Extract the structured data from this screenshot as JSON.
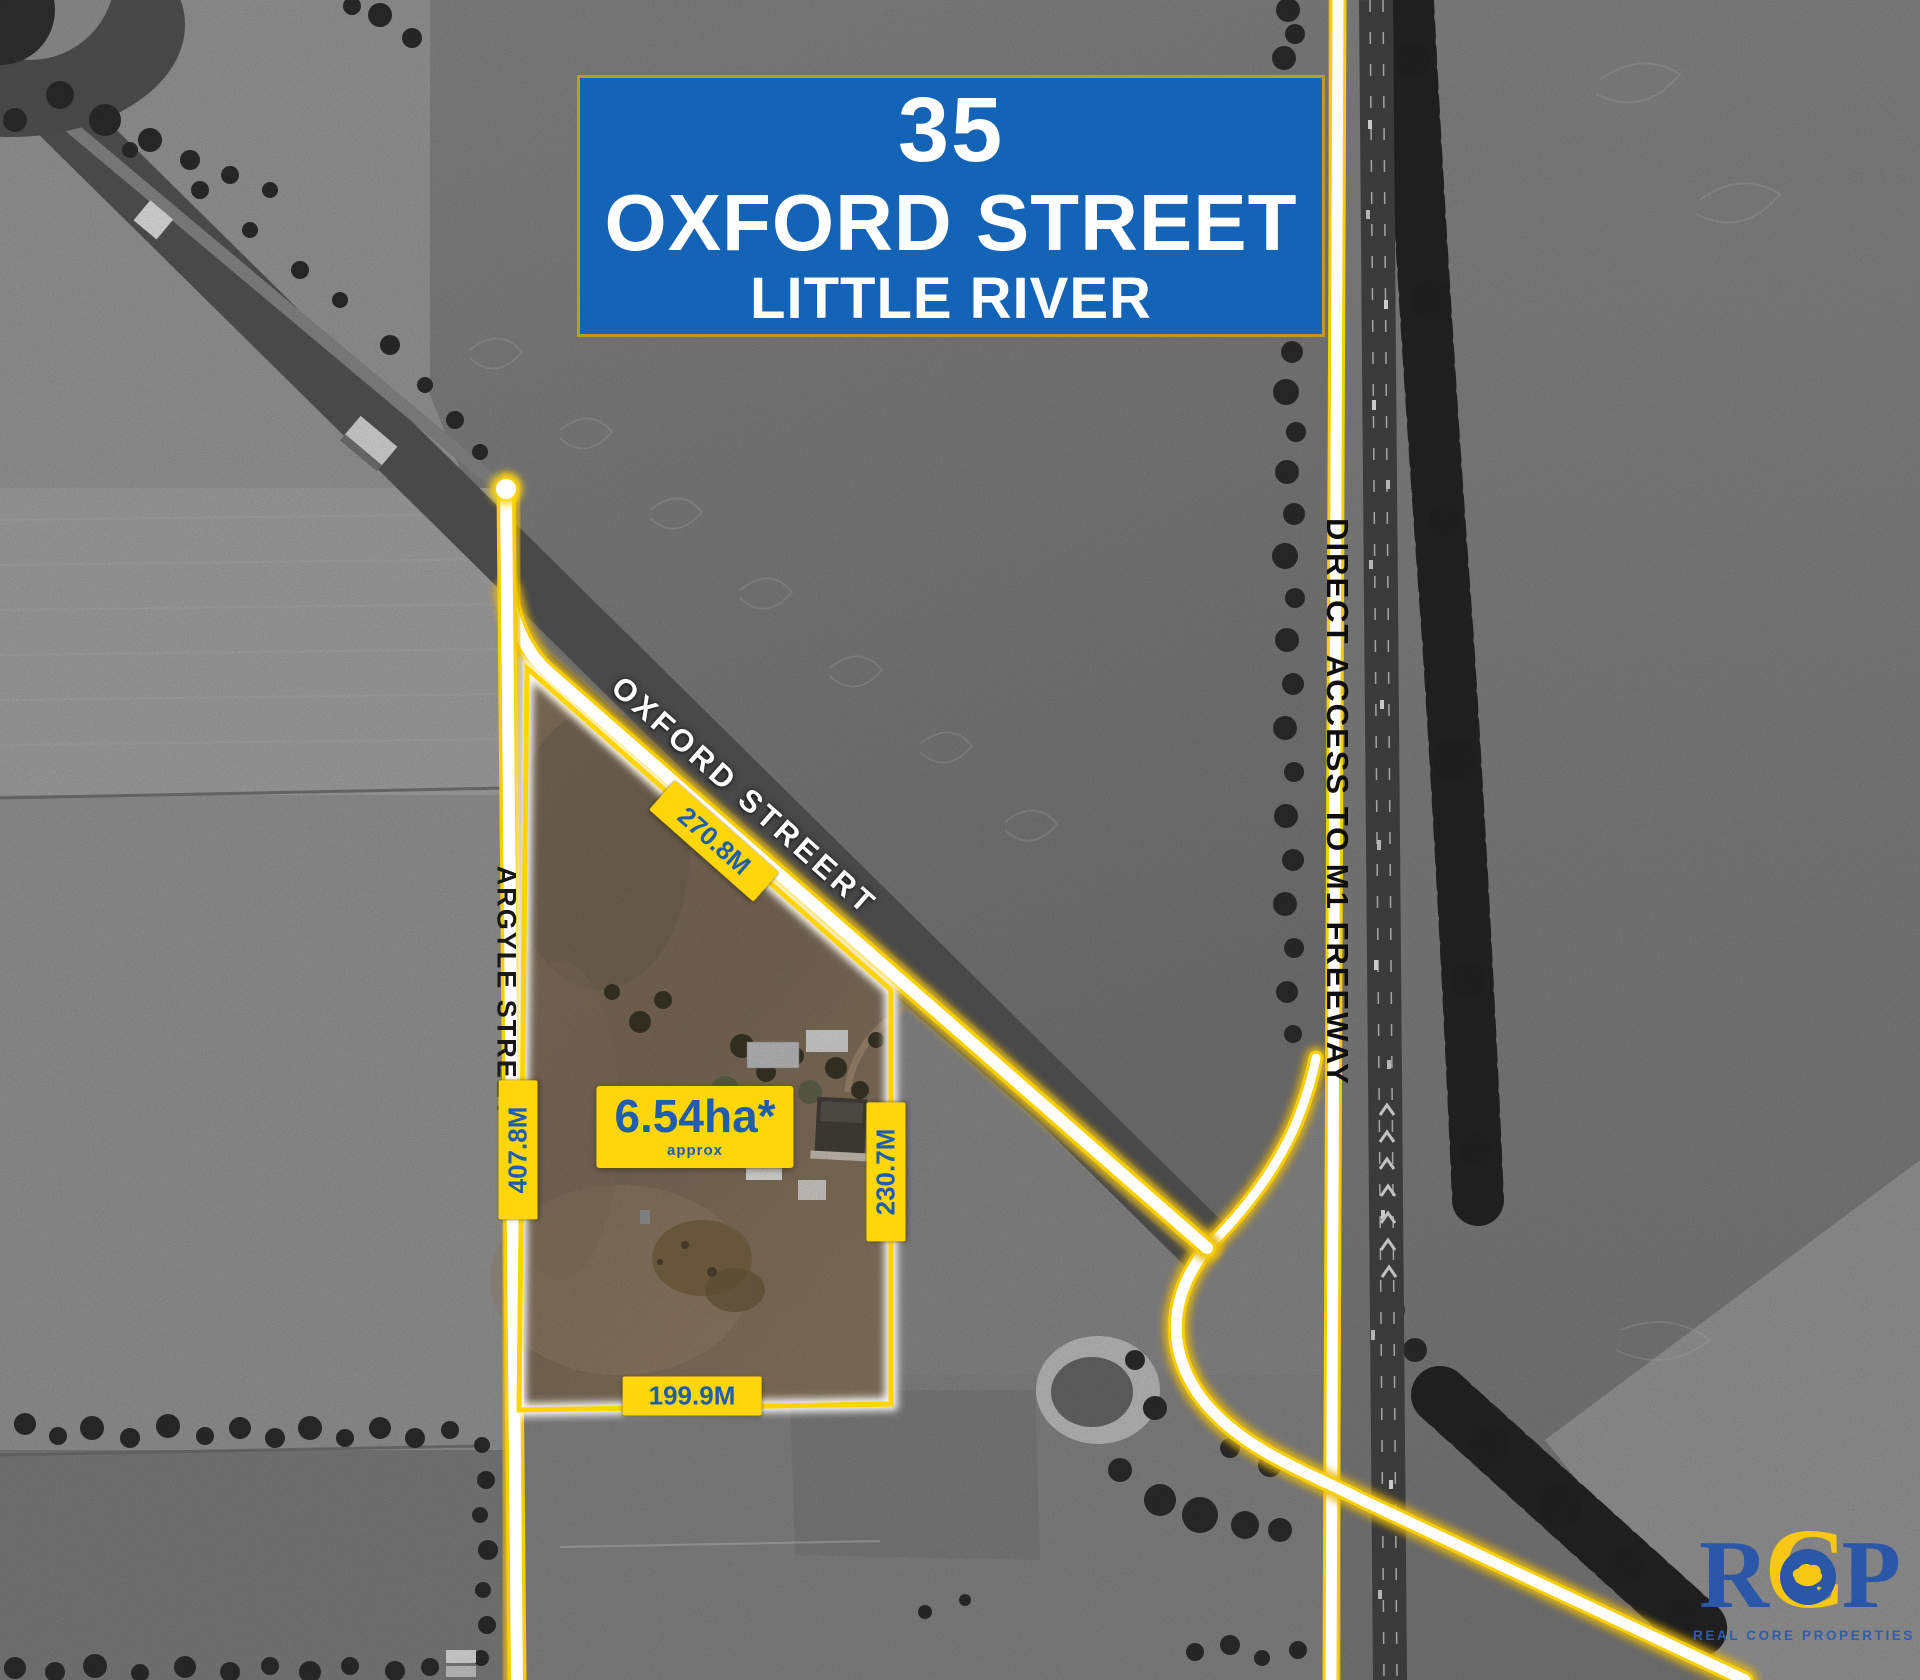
{
  "banner": {
    "number": "35",
    "street": "OXFORD STREET",
    "locality": "LITTLE RIVER"
  },
  "street_labels": {
    "oxford": "OXFORD STREERT",
    "argyle": "ARGYLE STREET",
    "freeway_access": "DIRECT ACCESS TO M1 FREEWAY"
  },
  "measurements": {
    "north_boundary": "270.8M",
    "west_boundary": "407.8M",
    "east_boundary": "230.7M",
    "south_boundary": "199.9M"
  },
  "area": {
    "value": "6.54ha*",
    "note": "approx"
  },
  "logo": {
    "letter_r": "R",
    "letter_c": "C",
    "letter_p": "P",
    "tagline": "REAL CORE PROPERTIES"
  },
  "colors": {
    "banner_blue": "#1363b7",
    "highlight_yellow": "#ffd60a",
    "measurement_blue": "#1f5dad",
    "boundary_yellow": "#ffd400",
    "logo_blue": "#2b57a8",
    "logo_yellow": "#f6c713"
  }
}
